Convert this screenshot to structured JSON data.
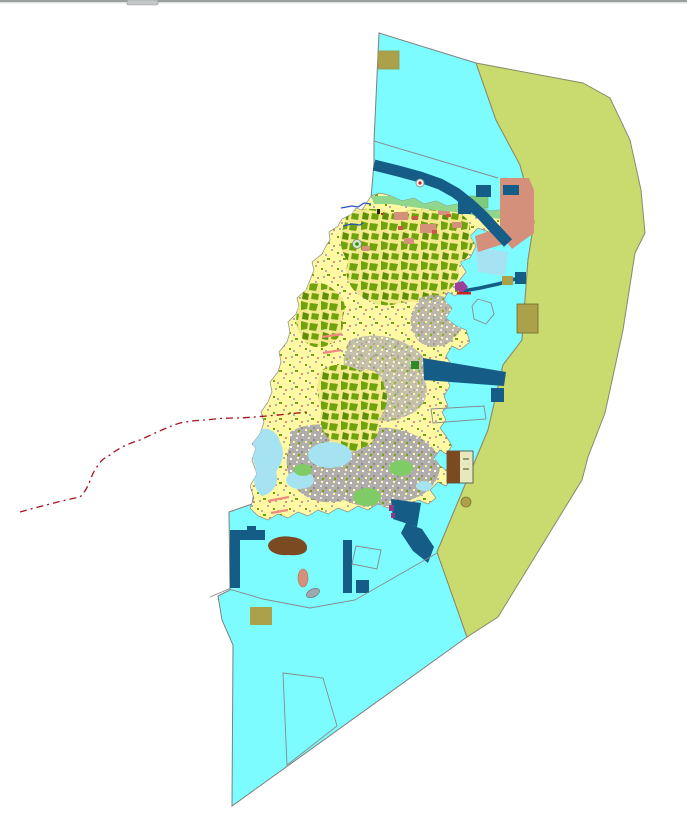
{
  "window": {
    "top_divider": {
      "bar_color": "#9a9e9e",
      "bar_highlight": "#e4e6e6",
      "tab_color": "#c2c6c6"
    }
  },
  "map": {
    "description": "land-use zoning map of an island with surrounding marine planning zones",
    "palette": {
      "sea_cyan": "#7cfcfe",
      "coastal_buffer_olive": "#c9da6e",
      "island_base_yellow": "#fff9a4",
      "vegetation_green": "#6fa30b",
      "vegetation_dark_green": "#5c8f06",
      "shore_strip_green": "#8fd78c",
      "green_parcel": "#7ecb7e",
      "light_green_patch": "#7fcb66",
      "urban_gray": "#b1adab",
      "reclamation_salmon": "#d4907a",
      "brick_red": "#c9574a",
      "marine_dark_blue": "#155c87",
      "wetland_pale_blue": "#a5e3f2",
      "soil_brown": "#7b4a21",
      "facility_khaki": "#aca04a",
      "facility_pale": "#e6e9be",
      "boundary_red": "#a6121f",
      "outline_gray": "#8a8a8a",
      "edge_gray": "#7e7e7e",
      "stream_blue": "#2a52be",
      "tick_pink": "#f08a7e",
      "islet_gray": "#9fa8b0",
      "pier_purple": "#9c3f9c",
      "pier_red": "#cc2222",
      "green_square": "#2e8b22",
      "magenta_mark": "#8e3b8e"
    },
    "features": [
      "sea-planning-zone",
      "coastal-buffer-zone",
      "island-landmass",
      "vegetation-parcels",
      "urban-parcels",
      "reclamation-area",
      "navigation-channel-band",
      "breakwater-line",
      "pier-complex",
      "marine-facility-rectangles",
      "khaki-facility-sites",
      "brown-soil-sites",
      "dashed-administrative-boundary",
      "survey-outline-polygons",
      "stream-lines",
      "shoreline-strip"
    ]
  }
}
